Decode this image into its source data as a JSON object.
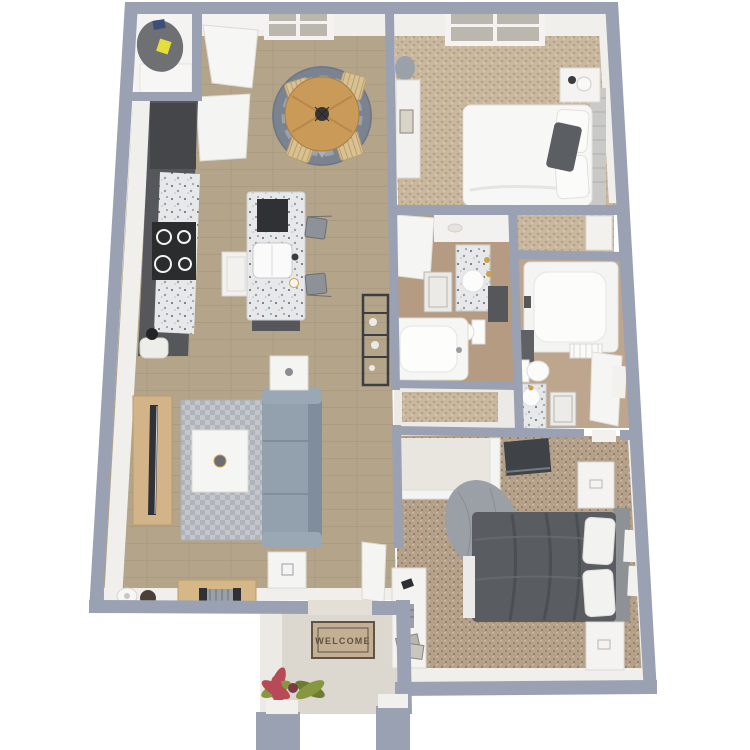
{
  "scene": {
    "type": "3d-floor-plan-rendering",
    "welcome_mat_text": "WELCOME"
  },
  "palette": {
    "wall": "#99a1b2",
    "white": "#f4f3f1",
    "whiteDim": "#eceae6",
    "band": "#f0efec",
    "wood": "#b3a48a",
    "woodLine": "#a29379",
    "carpet1": "#c9b79e",
    "carpet1dot": "#a28e73",
    "carpet2": "#b5a189",
    "carpet2dot": "#83705b",
    "granite": "#e7e8ea",
    "graniteDot": "#606268",
    "cabinet": "#55575b",
    "cabinetDark": "#44464a",
    "sofa": "#93a0ae",
    "sofaDark": "#7f8d9c",
    "rug": "#c3c6ca",
    "rugDot": "#afb4ba",
    "diningRug": "#7b8290",
    "diningRugLite": "#9ba2ad",
    "tableWood": "#c99a58",
    "chairWood": "#d9c191",
    "standWood": "#d3b488",
    "benchWood": "#d6b888",
    "bedDark": "#595c61",
    "headboard1": "#c9c9c7",
    "headboard2": "#8e9196",
    "bathFloor": "#b49b82",
    "bath2Floor": "#bda68d",
    "porch": "#dcd8d0",
    "mat": "#c4ae94",
    "matText": "#5f5446",
    "leafGreen": "#87973f",
    "leafRed": "#b84a58",
    "heater": "#6e7073",
    "sticker": "#e4de3a",
    "tv": "#303237",
    "gold": "#c9a24a",
    "windowPane": "#bab7ae",
    "blanket": "#9aa0a6"
  }
}
